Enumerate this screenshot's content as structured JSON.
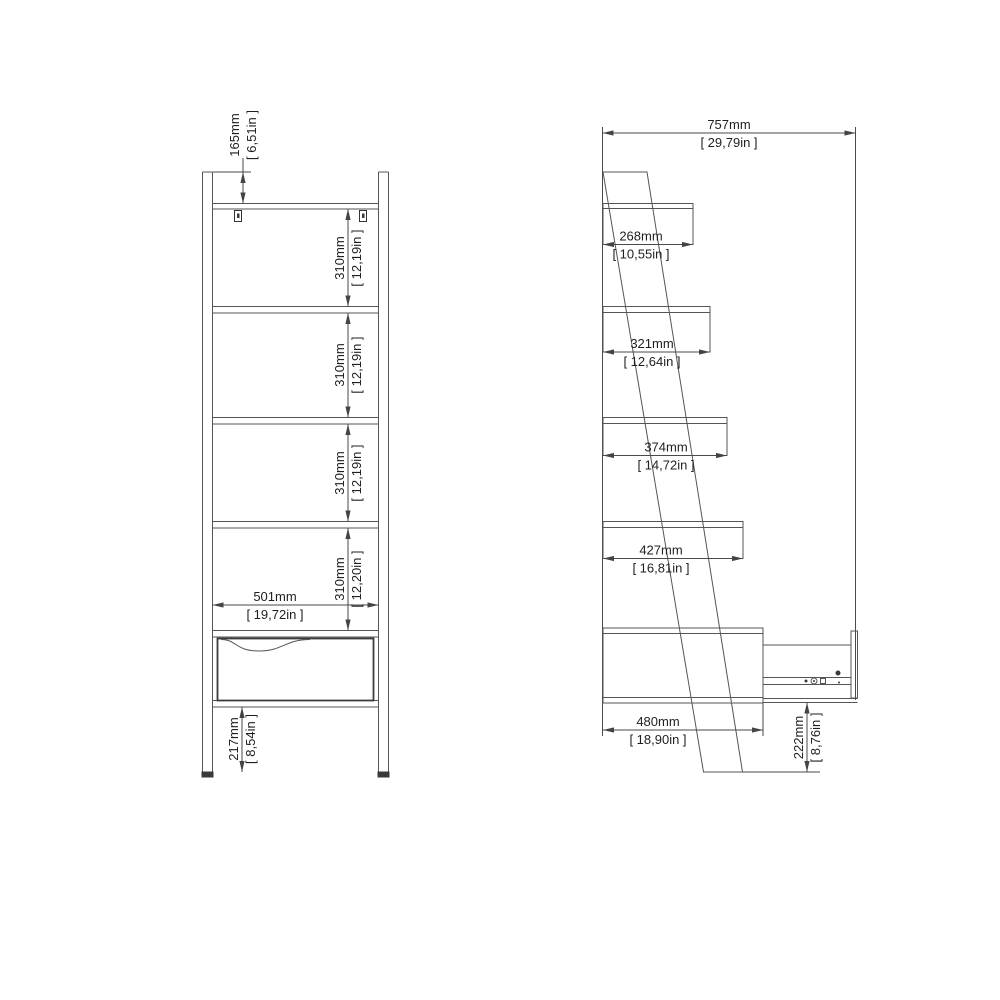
{
  "style": {
    "background": "#ffffff",
    "line_color": "#555555",
    "text_color": "#1f1f1f"
  },
  "front_view": {
    "top_offset": {
      "mm": "165mm",
      "inch": "[ 6,51in ]"
    },
    "gaps": [
      {
        "mm": "310mm",
        "inch": "[ 12,19in ]"
      },
      {
        "mm": "310mm",
        "inch": "[ 12,19in ]"
      },
      {
        "mm": "310mm",
        "inch": "[ 12,19in ]"
      },
      {
        "mm": "310mm",
        "inch": "[ 12,20in ]"
      }
    ],
    "inner_width": {
      "mm": "501mm",
      "inch": "[ 19,72in ]"
    },
    "base_height": {
      "mm": "217mm",
      "inch": "[ 8,54in ]"
    }
  },
  "side_view": {
    "total_depth": {
      "mm": "757mm",
      "inch": "[ 29,79in ]"
    },
    "shelf_depths": [
      {
        "mm": "268mm",
        "inch": "[ 10,55in ]"
      },
      {
        "mm": "321mm",
        "inch": "[ 12,64in ]"
      },
      {
        "mm": "374mm",
        "inch": "[ 14,72in ]"
      },
      {
        "mm": "427mm",
        "inch": "[ 16,81in ]"
      }
    ],
    "drawer_depth": {
      "mm": "480mm",
      "inch": "[ 18,90in ]"
    },
    "base_clearance": {
      "mm": "222mm",
      "inch": "[ 8,76in ]"
    }
  }
}
